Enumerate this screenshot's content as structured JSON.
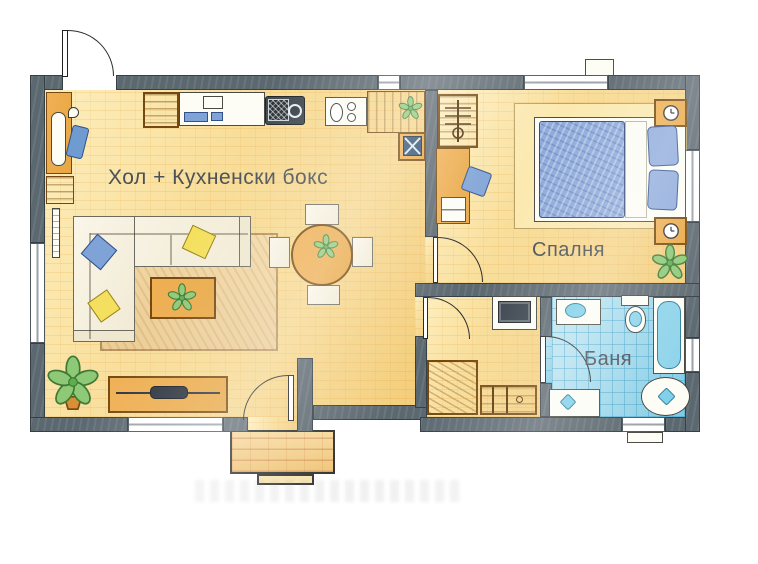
{
  "plan": {
    "type": "apartment-floor-plan",
    "style": "hand-drawn color sketch",
    "rooms": {
      "living_kitchen": {
        "label": "Хол + Кухненски бокс"
      },
      "bedroom": {
        "label": "Спалня"
      },
      "bathroom": {
        "label": "Баня"
      }
    }
  },
  "colors": {
    "wall": "#5c6870",
    "floor": "#f8dc96",
    "bath_floor": "#9bd6ea",
    "wood": "#e8a743",
    "accent_blue": "#7fa3d6",
    "plant_green": "#8ec978",
    "label_text": "#4b5156"
  }
}
